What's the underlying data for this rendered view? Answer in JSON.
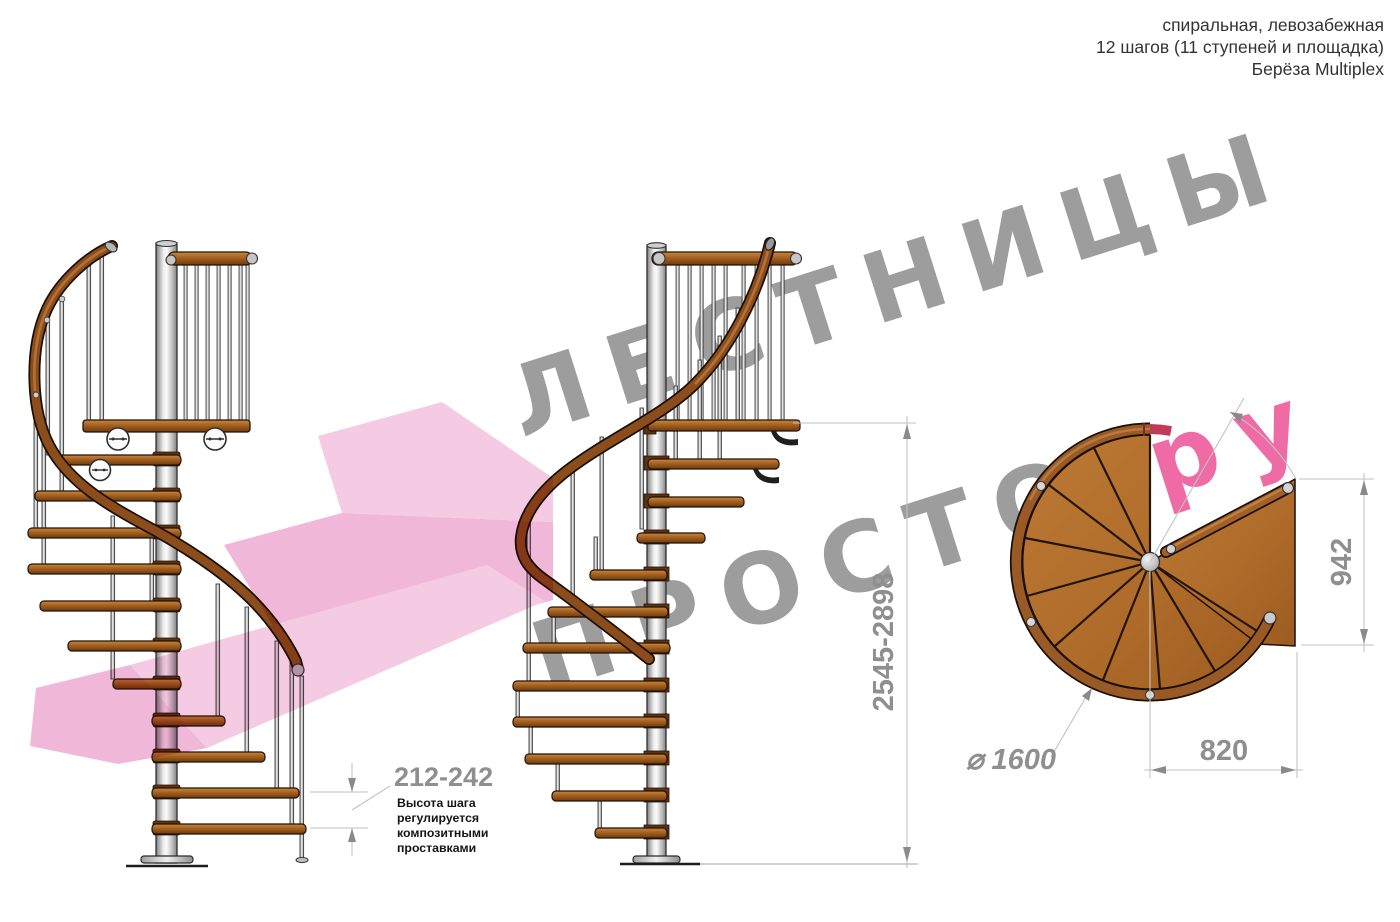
{
  "header": {
    "lines": [
      "спиральная, левозабежная",
      "12 шагов (11 ступеней и площадка)",
      "Берёза Multiplex"
    ]
  },
  "watermark": {
    "line1": "ЛЕСТНИЦЫ",
    "line2_gray": "ПРОСТО",
    "line2_pink": ".ру",
    "gray_color": "#9d9d9d",
    "pink_color": "#ef6ba6"
  },
  "dimensions": {
    "step_height": "212-242",
    "step_height_note": [
      "Высота шага",
      "регулируется",
      "композитными",
      "проставками"
    ],
    "total_height": "2545-2898",
    "landing_depth": "942",
    "landing_length": "820",
    "diameter": "⌀ 1600"
  },
  "colors": {
    "wood": "#b2702e",
    "wood_dark": "#8a4e1d",
    "rail": "#8c4d1c",
    "metal_light": "#e8e8e8",
    "dim_gray": "#8f8f8f",
    "crimson_overlap": "#c13a58",
    "arrow_pink_light": "#f4c2de",
    "arrow_pink_mid": "#efaad1"
  }
}
